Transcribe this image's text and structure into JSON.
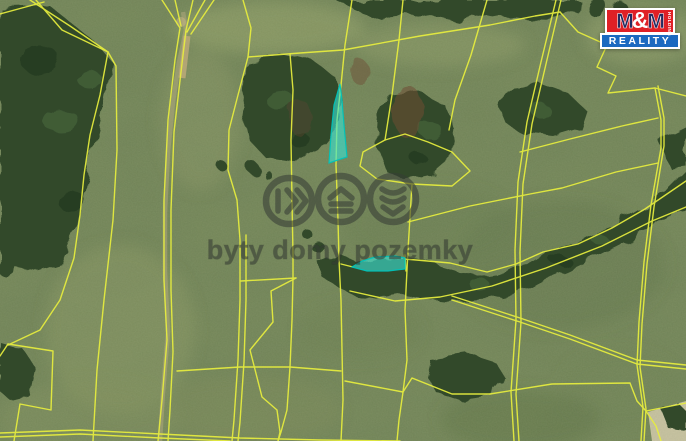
{
  "map": {
    "type": "aerial-cadastral-map",
    "boundary_color": "#e8ee3e",
    "highlight_color": "#38e2d2",
    "highlighted_parcel_count": 2
  },
  "watermark": {
    "text": "byty domy pozemky",
    "color": "#3a403a",
    "icons": [
      {
        "name": "byty-icon"
      },
      {
        "name": "domy-icon"
      },
      {
        "name": "pozemky-icon"
      }
    ]
  },
  "logo": {
    "line1": {
      "m1": "M",
      "amp": "&",
      "m2": "M"
    },
    "side_text": "HOLDING",
    "line2": "REALITY",
    "colors": {
      "red": "#df2026",
      "blue": "#1b69c0",
      "navy": "#232a60",
      "white": "#ffffff"
    }
  }
}
